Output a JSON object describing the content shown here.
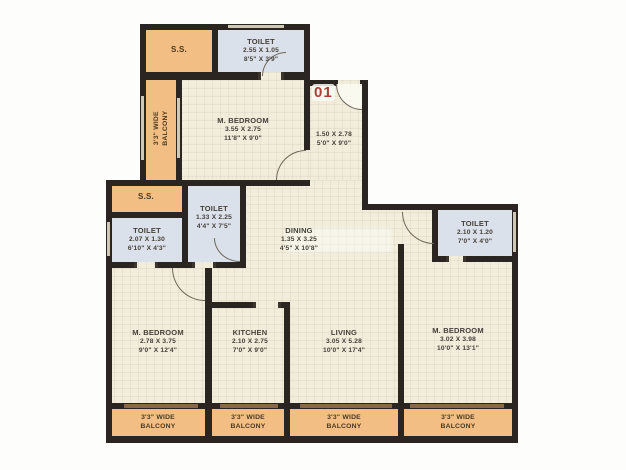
{
  "plan": {
    "unit_number": "01",
    "rooms": {
      "ss_top": {
        "name": "S.S."
      },
      "toilet_top": {
        "name": "TOILET",
        "size_m": "2.55 X 1.05",
        "size_ft": "8'5\" X 3'9\""
      },
      "balcony_side": {
        "line1": "3'3\" WIDE",
        "line2": "BALCONY"
      },
      "mbed_top": {
        "name": "M. BEDROOM",
        "size_m": "3.55 X 2.75",
        "size_ft": "11'8\" X 9'0\""
      },
      "foyer": {
        "size_m": "1.50 X 2.78",
        "size_ft": "5'0\" X 9'0\""
      },
      "ss_mid": {
        "name": "S.S."
      },
      "toilet_mid": {
        "name": "TOILET",
        "size_m": "1.33 X 2.25",
        "size_ft": "4'4\" X 7'5\""
      },
      "toilet_left": {
        "name": "TOILET",
        "size_m": "2.07 X 1.30",
        "size_ft": "6'10\" X 4'3\""
      },
      "dining": {
        "name": "DINING",
        "size_m": "1.35 X 3.25",
        "size_ft": "4'5\" X 10'8\""
      },
      "toilet_right": {
        "name": "TOILET",
        "size_m": "2.10 X 1.20",
        "size_ft": "7'0\" X 4'0\""
      },
      "mbed_left": {
        "name": "M. BEDROOM",
        "size_m": "2.78 X 3.75",
        "size_ft": "9'0\" X 12'4\""
      },
      "kitchen": {
        "name": "KITCHEN",
        "size_m": "2.10 X 2.75",
        "size_ft": "7'0\" X 9'0\""
      },
      "living": {
        "name": "LIVING",
        "size_m": "3.05 X 5.28",
        "size_ft": "10'0\" X 17'4\""
      },
      "mbed_right": {
        "name": "M. BEDROOM",
        "size_m": "3.02 X 3.98",
        "size_ft": "10'0\" X 13'1\""
      },
      "balcony_b1": {
        "line1": "3'3\" WIDE",
        "line2": "BALCONY"
      },
      "balcony_b2": {
        "line1": "3'3\" WIDE",
        "line2": "BALCONY"
      },
      "balcony_b3": {
        "line1": "3'3\" WIDE",
        "line2": "BALCONY"
      },
      "balcony_b4": {
        "line1": "3'3\" WIDE",
        "line2": "BALCONY"
      }
    },
    "colors": {
      "wall": "#2a2521",
      "floor": "#f2eddb",
      "balcony": "#f2be83",
      "toilet": "#dbe1ea",
      "unit_red": "#a93f38"
    }
  }
}
